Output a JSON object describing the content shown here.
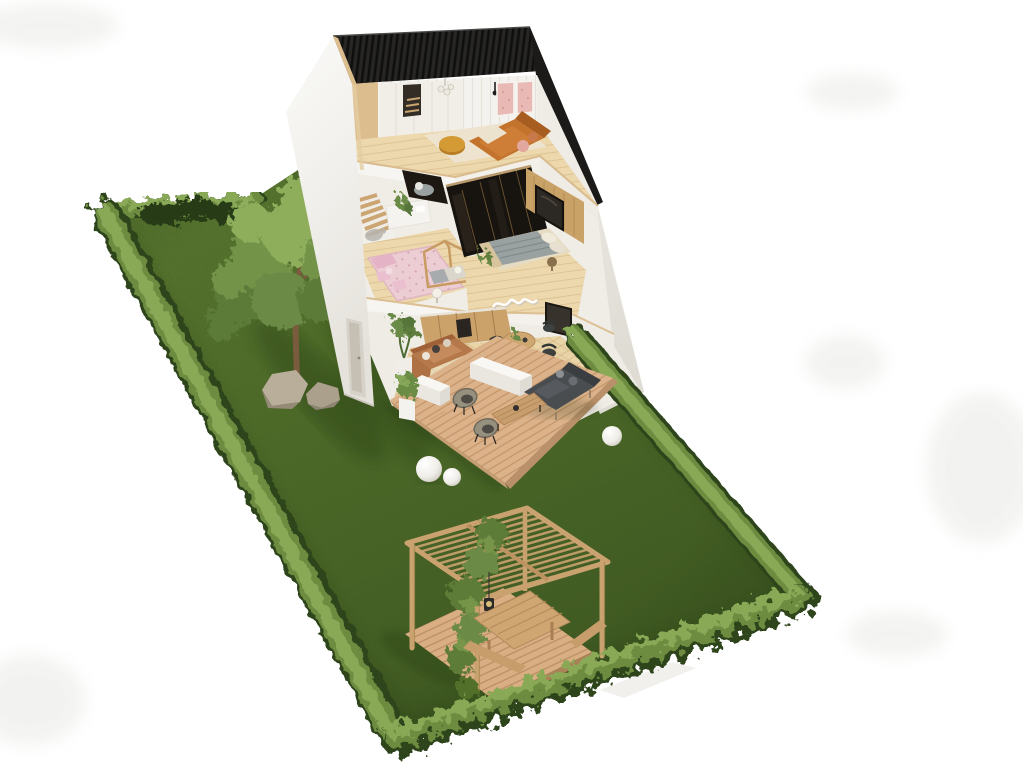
{
  "image": {
    "type": "3d-architectural-cutaway-render",
    "view": "isometric-aerial-dollhouse-view",
    "subject": "two-story gabled house with open cutaway interior on a long hedged garden plot",
    "background": "white studio backdrop"
  },
  "house": {
    "roof": {
      "style": "gabled",
      "finish": "black-slatted-battens"
    },
    "floors": [
      {
        "level": 2,
        "name": "attic-lounge",
        "items": [
          "orange-fabric-sofa",
          "ochre-round-pouf",
          "cream-area-rug",
          "two-pink-framed-wall-panels",
          "white-built-in-cabinets",
          "stair-opening",
          "glass-chandelier",
          "black-wall-lamp",
          "wood-plank-floor"
        ]
      },
      {
        "level": 1,
        "name": "middle-floor",
        "rooms": [
          {
            "name": "kids-room",
            "items": [
              "pink-patterned-rug",
              "pink-kids-seating-set",
              "wooden-house-frame-bed",
              "round-side-table",
              "grey-wall-decal",
              "wooden-staircase",
              "half-wall-with-plant"
            ]
          },
          {
            "name": "walk-in-closet",
            "items": [
              "dark-glass-wardrobe",
              "brass-frame-profiles",
              "grey-ottoman"
            ]
          },
          {
            "name": "master-bedroom",
            "items": [
              "double-bed-with-striped-grey-blanket",
              "wood-slat-headboard-wall",
              "large-dark-framed-artwork",
              "round-nightstand",
              "potted-plant"
            ]
          }
        ]
      },
      {
        "level": 0,
        "name": "ground-floor",
        "rooms": [
          {
            "name": "kitchen",
            "items": [
              "wood-cabinet-run",
              "built-in-dark-appliance"
            ]
          },
          {
            "name": "living-dining-room",
            "items": [
              "caramel-leather-sofa",
              "round-wood-dining-table",
              "three-dark-shell-chairs",
              "tall-potted-plant",
              "white-neon-squiggle-wall-art",
              "dark-framed-artwork",
              "herringbone-wood-floor"
            ]
          }
        ]
      }
    ]
  },
  "garden": {
    "lawn": "long rectangular lawn seen in isometric perspective",
    "boundary": "clipped green hedges along all four sides",
    "tree": {
      "type": "single deciduous tree",
      "base": "two sandstone boulders"
    },
    "patio": {
      "name": "timber-deck-terrace",
      "items": [
        "dark-grey-outdoor-sofa",
        "two-rope-lounge-chairs",
        "slatted-wood-coffee-table",
        "white-parapet-planter-boxes",
        "ball-topiary-in-white-pot",
        "three-white-sphere-ground-lamps"
      ]
    },
    "pergola": {
      "name": "timber-pergola",
      "base": "small-timber-deck",
      "items": [
        "slatted-flat-roof",
        "climbing-vine",
        "wood-picnic-table",
        "two-benches",
        "black-hanging-lantern"
      ]
    }
  },
  "palette": {
    "bg": "#ffffff",
    "smudge": "#ebebe8",
    "lawnLight": "#5d7a31",
    "lawnMid": "#4b6827",
    "lawnDark": "#3c5520",
    "hedge": "#6d8c41",
    "hedgeLight": "#8aa957",
    "hedgeDark": "#2d441b",
    "bushDark": "#263a17",
    "roof": "#272625",
    "roofEdge": "#1b1a18",
    "wall": "#f1efeb",
    "wallBright": "#fafaf8",
    "wallShade": "#e5e2db",
    "woodCut": "#dcbd8e",
    "atticFloor": "#ecd8ac",
    "deck": "#dcb28a",
    "deckLine": "#c39468",
    "pergolaWood": "#c9a26f",
    "sofaOrange": "#c4732d",
    "pouf": "#d49a33",
    "rugCream": "#ece3cf",
    "pinkPanel": "#e9bab5",
    "pinkRug": "#eccdd4",
    "pinkFurniture": "#e5b3c6",
    "closetDark": "#17130f",
    "brass": "#7c6237",
    "headboardWood": "#c9a268",
    "blanketGrey": "#9aa1a1",
    "sheetBeige": "#e6dcc4",
    "sofaCaramel": "#b5784a",
    "kitchenWood": "#caa26a",
    "tableWood": "#cfa770",
    "chairDark": "#3c403e",
    "patioSofa": "#4a4d50",
    "ropeChair": "#96907f",
    "sphereLamp": "#f4f2ee",
    "foliage": "#73934a",
    "foliageLight": "#8eae5b",
    "foliageDark": "#5b7a38",
    "vine": "#5d7b39",
    "trunk": "#7a5b3e",
    "rock": "#b9ae9a",
    "shadowGreen": "#1c3110"
  }
}
